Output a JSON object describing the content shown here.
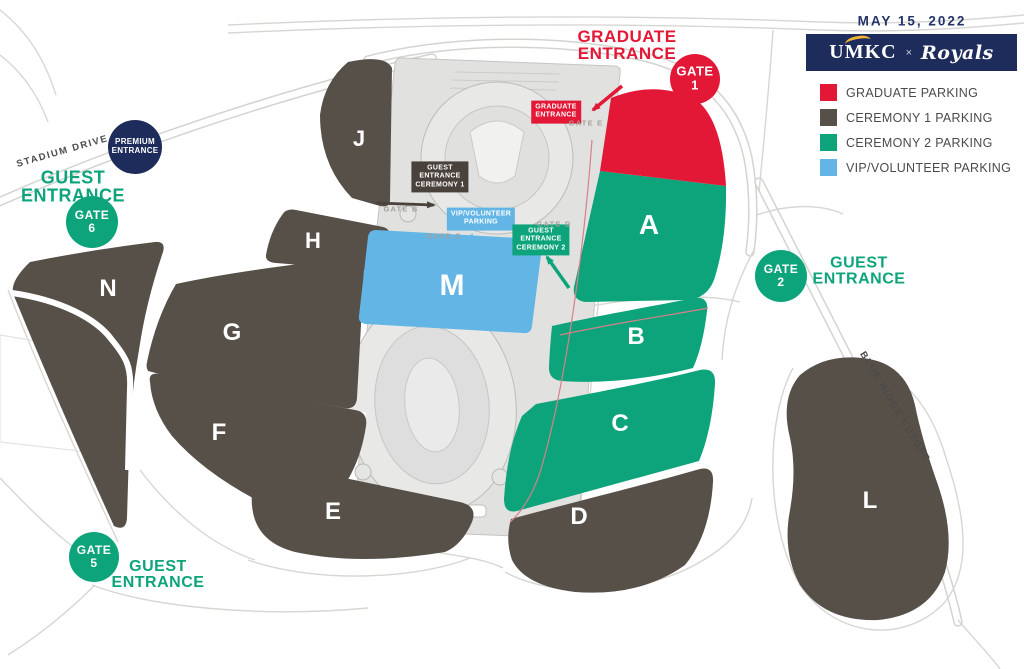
{
  "header": {
    "date": "MAY 15, 2022",
    "umkc": "UMKC",
    "separator": "×",
    "royals": "Royals"
  },
  "legend": {
    "items": [
      {
        "label": "GRADUATE PARKING",
        "color": "#e31837"
      },
      {
        "label": "CEREMONY 1 PARKING",
        "color": "#575049"
      },
      {
        "label": "CEREMONY 2 PARKING",
        "color": "#0da47b"
      },
      {
        "label": "VIP/VOLUNTEER PARKING",
        "color": "#62b5e5"
      }
    ]
  },
  "colors": {
    "graduate": "#e31837",
    "ceremony1": "#575049",
    "ceremony1_dark": "#48413c",
    "ceremony2": "#0da47b",
    "vip": "#62b5e5",
    "navy": "#1e2c5c",
    "text_navy": "#25346a"
  },
  "roads": {
    "stadium_drive": "STADIUM DRIVE",
    "blue_ridge_cutoff": "BLUE RIDGE CUTOFF"
  },
  "entrances": {
    "graduate": [
      "GRADUATE",
      "ENTRANCE"
    ],
    "guest_west": [
      "GUEST",
      "ENTRANCE"
    ],
    "guest_east": [
      "GUEST",
      "ENTRANCE"
    ],
    "guest_south": [
      "GUEST",
      "ENTRANCE"
    ],
    "premium": [
      "PREMIUM",
      "ENTRANCE"
    ]
  },
  "gates": [
    {
      "label": "GATE",
      "number": "1"
    },
    {
      "label": "GATE",
      "number": "2"
    },
    {
      "label": "GATE",
      "number": "5"
    },
    {
      "label": "GATE",
      "number": "6"
    }
  ],
  "callouts": {
    "graduate": [
      "GRADUATE",
      "ENTRANCE"
    ],
    "ceremony1": [
      "GUEST",
      "ENTRANCE",
      "CEREMONY 1"
    ],
    "vip": [
      "VIP/VOLUNTEER",
      "PARKING"
    ],
    "ceremony2": [
      "GUEST",
      "ENTRANCE",
      "CEREMONY 2"
    ]
  },
  "gate_points": [
    "GATE E",
    "GATE B",
    "GATE C",
    "GATE D"
  ],
  "lots": [
    {
      "letter": "A",
      "category": "Graduate / Ceremony 2"
    },
    {
      "letter": "B",
      "category": "Ceremony 2"
    },
    {
      "letter": "C",
      "category": "Ceremony 2"
    },
    {
      "letter": "D",
      "category": "Ceremony 1"
    },
    {
      "letter": "E",
      "category": "Ceremony 1"
    },
    {
      "letter": "F",
      "category": "Ceremony 1"
    },
    {
      "letter": "G",
      "category": "Ceremony 1"
    },
    {
      "letter": "H",
      "category": "Ceremony 1"
    },
    {
      "letter": "J",
      "category": "Ceremony 1"
    },
    {
      "letter": "L",
      "category": "Ceremony 1"
    },
    {
      "letter": "M",
      "category": "VIP/Volunteer"
    },
    {
      "letter": "N",
      "category": "Ceremony 1"
    }
  ]
}
